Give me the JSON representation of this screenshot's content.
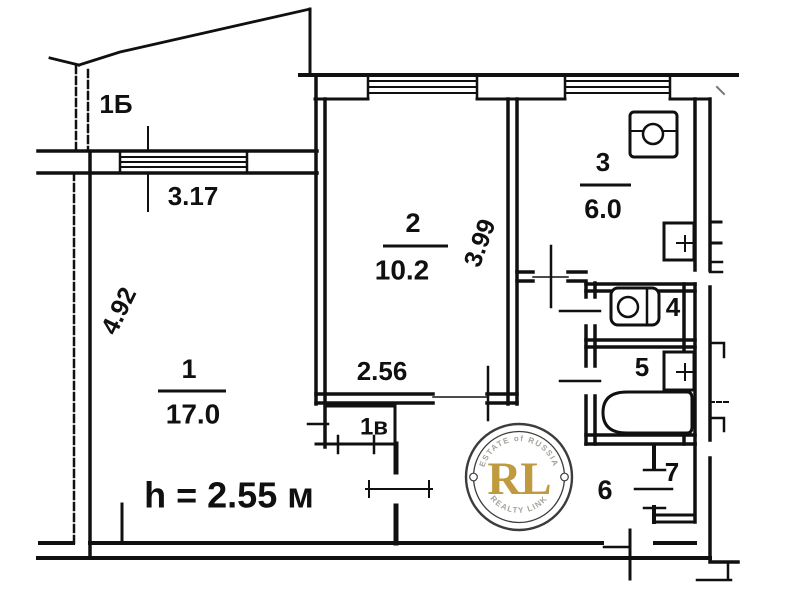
{
  "plan": {
    "wall_color": "#101010",
    "balcony_label": "1Б",
    "closet_label": "1в",
    "height_note": "h = 2.55 м",
    "rooms": [
      {
        "number": "1",
        "area": "17.0"
      },
      {
        "number": "2",
        "area": "10.2"
      },
      {
        "number": "3",
        "area": "6.0"
      },
      {
        "number": "4"
      },
      {
        "number": "5"
      },
      {
        "number": "6"
      },
      {
        "number": "7"
      }
    ],
    "dimensions": {
      "balcony_window_width": "3.17",
      "room1_depth": "4.92",
      "room2_depth": "3.99",
      "room2_width": "2.56"
    },
    "fixtures": [
      "stove-icon",
      "kitchen-sink-icon",
      "toilet-icon",
      "bathroom-sink-icon",
      "bathtub-icon"
    ]
  },
  "watermark": {
    "monogram": "RL",
    "arc_top": "ESTATE of RUSSIA",
    "arc_bottom": "REALTY LINK",
    "gold_color": "#bf9a3e",
    "ring_color": "#3c3c3c",
    "arc_text_color": "#a3a39b"
  }
}
